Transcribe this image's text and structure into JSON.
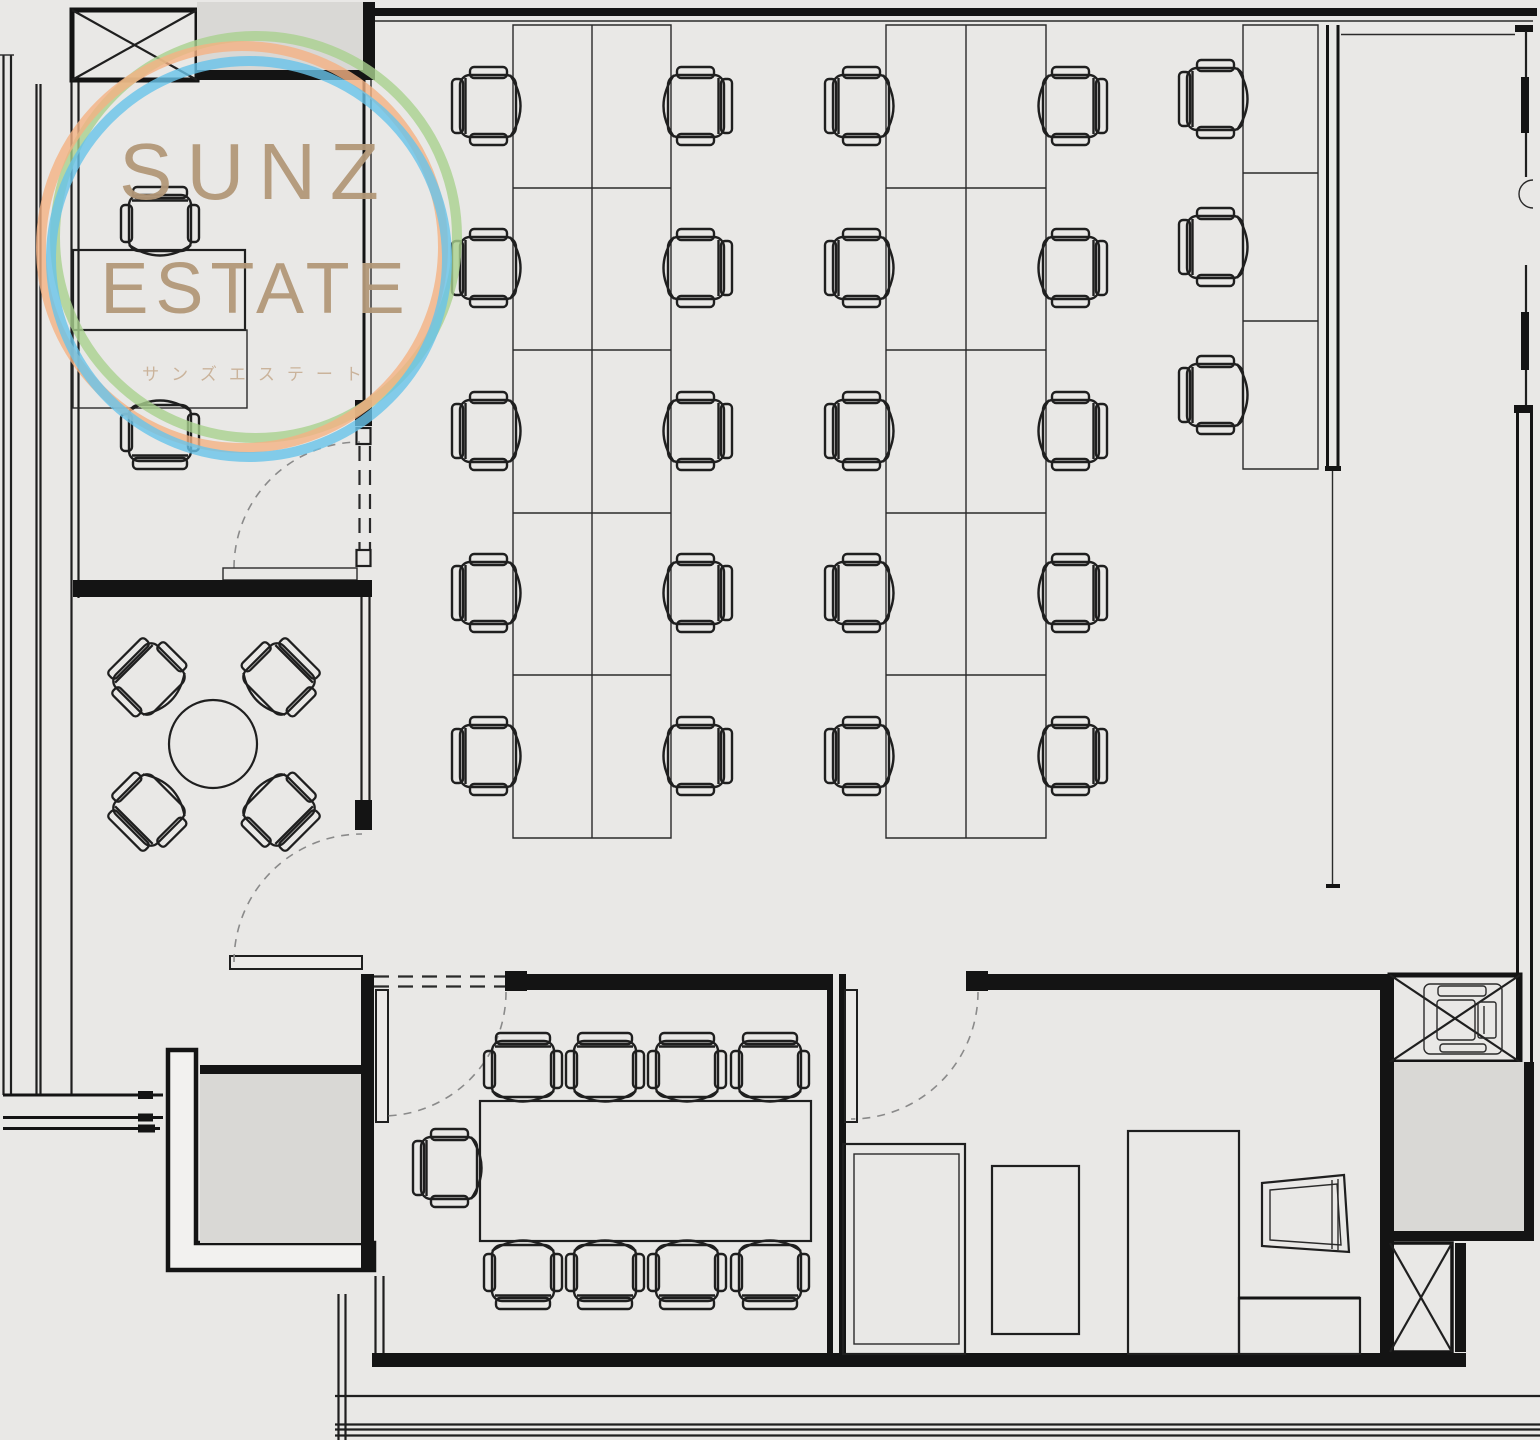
{
  "logo": {
    "title_line1": "SUNZ",
    "title_line2": "ESTATE",
    "subtitle_jp": "サンズエステート",
    "text_color": "#b39879",
    "subtitle_color": "#c9b198",
    "ring_colors": {
      "green": "#a9d18e",
      "orange": "#f4b183",
      "blue": "#68c3ea"
    }
  },
  "floor_plan": {
    "background_color": "#e9e8e6",
    "line_color": "#1f1f1f",
    "wall_color": "#141414",
    "shaft_fill_color": "#d9d8d5",
    "rooms": [
      {
        "name": "executive-office",
        "furniture": {
          "desks": 2,
          "chairs": 2
        }
      },
      {
        "name": "open-office",
        "furniture": {
          "desk_banks": 3,
          "desks": 23,
          "chairs": 23
        }
      },
      {
        "name": "small-meeting-room",
        "furniture": {
          "round_tables": 1,
          "chairs": 4
        }
      },
      {
        "name": "meeting-room",
        "furniture": {
          "conference_tables": 1,
          "chairs": 9
        }
      },
      {
        "name": "storage-room",
        "furniture": {
          "cabinets": 5
        }
      },
      {
        "name": "entrance-vestibule",
        "furniture": {}
      },
      {
        "name": "elevator-hall",
        "furniture": {}
      }
    ],
    "symbols": [
      "chair",
      "desk",
      "door-swing",
      "shaft-x-box",
      "window-wall",
      "printer"
    ]
  }
}
